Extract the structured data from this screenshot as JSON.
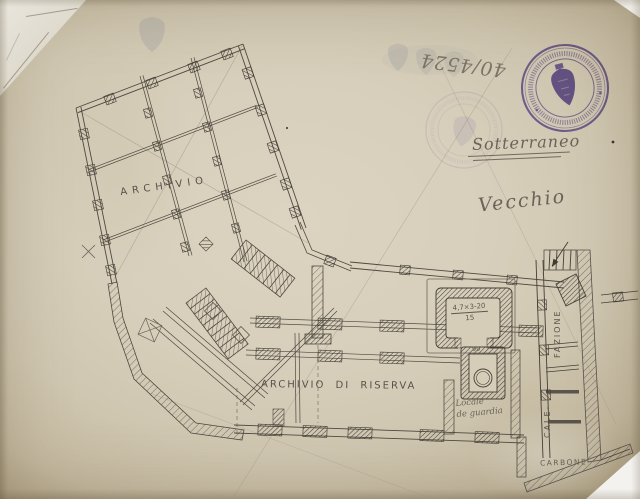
{
  "drawing": {
    "handwritten_notes": {
      "file_number": "40/4524",
      "level": "Sotterraneo",
      "qualifier": "Vecchio"
    },
    "room_labels": {
      "archivio": "ARCHIVIO",
      "archivio_di_riserva": "ARCHIVIO DI RISERVA",
      "calefazione_upper": "FAZIONE",
      "calefazione_lower": "CALE-",
      "carbone": "CARBONE",
      "guard_room_line1": "Locale",
      "guard_room_line2": "de guardia"
    },
    "measurements": {
      "room_dimensions": "4,7×3-20",
      "room_area": "15",
      "shaft_mark": "99"
    }
  },
  "stamp": {
    "emblem": "shield-icon",
    "ink_color": "#5a43ac"
  },
  "colors": {
    "paper": "#d6cdb9",
    "ink": "#4e483f",
    "pencil": "#9a9181",
    "stamp_ink": "#5a43ac"
  }
}
